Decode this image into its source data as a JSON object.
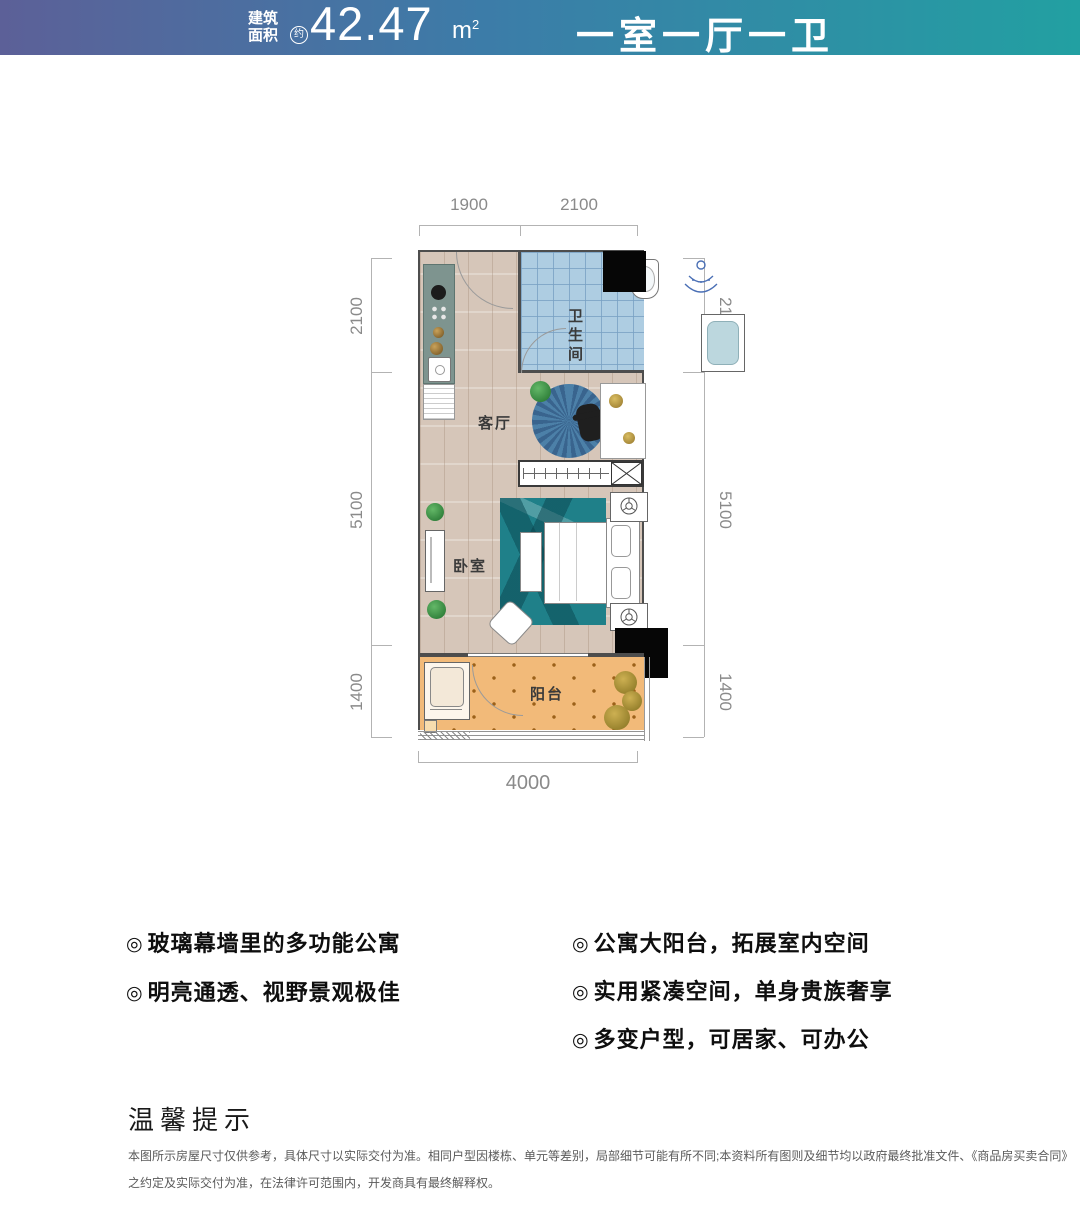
{
  "header": {
    "area_label_line1": "建筑",
    "area_label_line2": "面积",
    "approx_badge": "约",
    "area_value": "42.47",
    "area_unit_base": "m",
    "area_unit_exp": "2",
    "layout_title": "一室一厅一卫",
    "gradient_left": "#5c6098",
    "gradient_right": "#22a0a2"
  },
  "rooms": {
    "bathroom": "卫生间",
    "living": "客厅",
    "bedroom": "卧室",
    "balcony": "阳台"
  },
  "dims": {
    "top": [
      "1900",
      "2100"
    ],
    "bottom": [
      "4000"
    ],
    "left": [
      "2100",
      "5100",
      "1400"
    ],
    "right": [
      "2100",
      "5100",
      "1400"
    ]
  },
  "features": {
    "bullet": "◎",
    "left": [
      "玻璃幕墙里的多功能公寓",
      "明亮通透、视野景观极佳"
    ],
    "right": [
      "公寓大阳台，拓展室内空间",
      "实用紧凑空间，单身贵族奢享",
      "多变户型，可居家、可办公"
    ]
  },
  "notice": {
    "title": "温馨提示",
    "line1": "本图所示房屋尺寸仅供参考，具体尺寸以实际交付为准。相同户型因楼栋、单元等差别，局部细节可能有所不同;本资料所有图则及细节均以政府最终批准文件、《商品房买卖合同》",
    "line2": "之约定及实际交付为准，在法律许可范围内，开发商具有最终解释权。"
  }
}
